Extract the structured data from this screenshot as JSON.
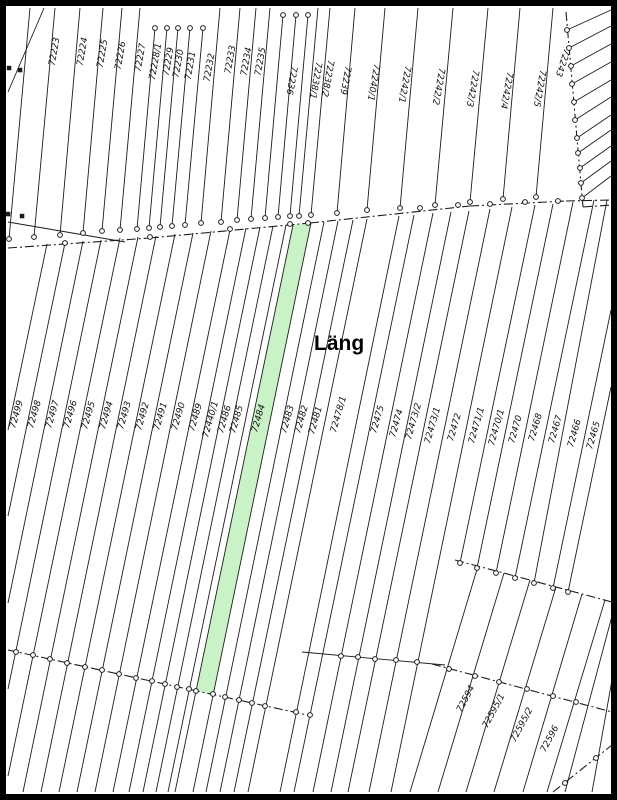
{
  "map": {
    "width": 617,
    "height": 800,
    "background": "#ffffff",
    "frame_color": "#000000",
    "line_color": "#1c1c1c",
    "label_color": "#111111",
    "highlighted_parcel": {
      "number": "72484",
      "fill": "#c9f2c6",
      "points": "293,225 311,223 213,694 196,691"
    },
    "area_label": {
      "text": "Läng",
      "x": 314,
      "y": 350,
      "size": 21
    },
    "parcel_numbers_top": [
      "72223",
      "72224",
      "72225",
      "72226",
      "72227",
      "72228/1",
      "72229",
      "72230",
      "72231",
      "72232",
      "72233",
      "72234",
      "72235",
      "72236",
      "72238/1",
      "72238/2",
      "72239",
      "72240/1",
      "72242/1",
      "72242/2",
      "72242/3",
      "72242/4",
      "72242/5",
      "72243"
    ],
    "parcel_numbers_middle": [
      "72499",
      "72498",
      "72497",
      "72496",
      "72495",
      "72494",
      "72493",
      "72492",
      "72491",
      "72490",
      "72489",
      "72440/1",
      "72486",
      "72485",
      "72484",
      "72483",
      "72482",
      "72481",
      "72478/1",
      "72475",
      "72474",
      "72473/2",
      "72473/1",
      "72472",
      "72471/1",
      "72470/1",
      "72470",
      "72468",
      "72467",
      "72466",
      "72465"
    ],
    "parcel_numbers_bottom_right": [
      "72594",
      "72595/1",
      "72595/2",
      "72596"
    ],
    "labels": [
      [
        "72223",
        57,
        52,
        -80
      ],
      [
        "72224",
        85,
        52,
        -80
      ],
      [
        "72225",
        105,
        54,
        -80
      ],
      [
        "72226",
        123,
        56,
        -80
      ],
      [
        "72227",
        143,
        58,
        -80
      ],
      [
        "72228/1",
        158,
        62,
        -80
      ],
      [
        "72229",
        171,
        62,
        -80
      ],
      [
        "72230",
        181,
        64,
        -80
      ],
      [
        "72231",
        193,
        66,
        -80
      ],
      [
        "72232",
        212,
        68,
        -80
      ],
      [
        "72233",
        233,
        60,
        -80
      ],
      [
        "72234",
        249,
        62,
        -80
      ],
      [
        "72235",
        263,
        62,
        -80
      ],
      [
        "72236",
        289,
        80,
        100
      ],
      [
        "72238/1",
        313,
        80,
        100
      ],
      [
        "72238/2",
        325,
        78,
        100
      ],
      [
        "72239",
        343,
        80,
        100
      ],
      [
        "72240/1",
        371,
        82,
        100
      ],
      [
        "72242/1",
        402,
        84,
        100
      ],
      [
        "72242/2",
        436,
        86,
        100
      ],
      [
        "72242/3",
        470,
        88,
        100
      ],
      [
        "72242/4",
        504,
        90,
        100
      ],
      [
        "72242/5",
        537,
        88,
        100
      ],
      [
        "72243",
        560,
        62,
        108
      ],
      [
        "72499",
        19,
        415,
        -74
      ],
      [
        "72498",
        37,
        415,
        -74
      ],
      [
        "72497",
        55,
        415,
        -74
      ],
      [
        "72496",
        73,
        415,
        -74
      ],
      [
        "72495",
        91,
        416,
        -74
      ],
      [
        "72494",
        109,
        416,
        -74
      ],
      [
        "72493",
        127,
        416,
        -74
      ],
      [
        "72492",
        145,
        417,
        -74
      ],
      [
        "72491",
        163,
        417,
        -74
      ],
      [
        "72490",
        181,
        417,
        -74
      ],
      [
        "72489",
        198,
        418,
        -74
      ],
      [
        "72440/1",
        213,
        420,
        -74
      ],
      [
        "72486",
        227,
        420,
        -74
      ],
      [
        "72485",
        239,
        420,
        -74
      ],
      [
        "72484",
        261,
        419,
        -74
      ],
      [
        "72483",
        290,
        420,
        -74
      ],
      [
        "72482",
        304,
        420,
        -74
      ],
      [
        "72481",
        318,
        421,
        -74
      ],
      [
        "72478/1",
        341,
        415,
        -74
      ],
      [
        "72475",
        380,
        420,
        -74
      ],
      [
        "72474",
        399,
        424,
        -74
      ],
      [
        "72473/2",
        416,
        422,
        -74
      ],
      [
        "72473/1",
        435,
        426,
        -74
      ],
      [
        "72472",
        457,
        428,
        -74
      ],
      [
        "72471/1",
        479,
        426,
        -74
      ],
      [
        "72470/1",
        499,
        428,
        -74
      ],
      [
        "72470",
        518,
        430,
        -74
      ],
      [
        "72468",
        538,
        428,
        -74
      ],
      [
        "72467",
        558,
        430,
        -74
      ],
      [
        "72466",
        577,
        434,
        -74
      ],
      [
        "72465",
        596,
        436,
        -74
      ],
      [
        "72594",
        468,
        700,
        -62
      ],
      [
        "72595/1",
        496,
        712,
        -62
      ],
      [
        "72595/2",
        524,
        726,
        -62
      ],
      [
        "72596",
        552,
        740,
        -62
      ]
    ],
    "solid_lines": [
      [
        30,
        8,
        9,
        239
      ],
      [
        55,
        8,
        34,
        237
      ],
      [
        80,
        8,
        60,
        235
      ],
      [
        103,
        8,
        83,
        233
      ],
      [
        122,
        8,
        102,
        231
      ],
      [
        140,
        8,
        120,
        230
      ],
      [
        155,
        28,
        137,
        229
      ],
      [
        167,
        28,
        149,
        228
      ],
      [
        178,
        28,
        160,
        227
      ],
      [
        190,
        28,
        172,
        226
      ],
      [
        203,
        28,
        185,
        225
      ],
      [
        220,
        8,
        201,
        223
      ],
      [
        240,
        8,
        221,
        222
      ],
      [
        256,
        8,
        237,
        220
      ],
      [
        270,
        8,
        251,
        219
      ],
      [
        283,
        15,
        265,
        218
      ],
      [
        296,
        15,
        278,
        217
      ],
      [
        308,
        15,
        290,
        216
      ],
      [
        318,
        8,
        299,
        216
      ],
      [
        330,
        8,
        311,
        215
      ],
      [
        355,
        8,
        337,
        213
      ],
      [
        385,
        8,
        367,
        210
      ],
      [
        418,
        8,
        400,
        208
      ],
      [
        453,
        8,
        435,
        205
      ],
      [
        488,
        8,
        470,
        202
      ],
      [
        520,
        8,
        503,
        199
      ],
      [
        553,
        8,
        536,
        197
      ],
      [
        567,
        30,
        611,
        10
      ],
      [
        569,
        48,
        611,
        26
      ],
      [
        571,
        66,
        611,
        44
      ],
      [
        572,
        84,
        611,
        62
      ],
      [
        574,
        102,
        611,
        80
      ],
      [
        575,
        120,
        611,
        97
      ],
      [
        577,
        138,
        611,
        115
      ],
      [
        578,
        153,
        611,
        130
      ],
      [
        580,
        168,
        611,
        146
      ],
      [
        581,
        183,
        611,
        161
      ],
      [
        582,
        198,
        611,
        176
      ],
      [
        47,
        244,
        8,
        430
      ],
      [
        65,
        243,
        8,
        516
      ],
      [
        83,
        241,
        8,
        603
      ],
      [
        101,
        240,
        8,
        689
      ],
      [
        120,
        238,
        8,
        776
      ],
      [
        138,
        237,
        23,
        792
      ],
      [
        156,
        236,
        41,
        792
      ],
      [
        175,
        234,
        59,
        792
      ],
      [
        193,
        233,
        77,
        792
      ],
      [
        211,
        231,
        95,
        792
      ],
      [
        230,
        230,
        113,
        792
      ],
      [
        246,
        228,
        129,
        792
      ],
      [
        260,
        227,
        143,
        792
      ],
      [
        273,
        226,
        156,
        792
      ],
      [
        286,
        225,
        168,
        792
      ],
      [
        293,
        225,
        175,
        792
      ],
      [
        311,
        223,
        193,
        792
      ],
      [
        324,
        222,
        206,
        792
      ],
      [
        338,
        221,
        220,
        792
      ],
      [
        353,
        220,
        234,
        792
      ],
      [
        367,
        219,
        248,
        792
      ],
      [
        399,
        216,
        280,
        792
      ],
      [
        414,
        215,
        294,
        792
      ],
      [
        433,
        213,
        313,
        792
      ],
      [
        451,
        212,
        331,
        792
      ],
      [
        469,
        211,
        348,
        792
      ],
      [
        490,
        209,
        369,
        792
      ],
      [
        512,
        207,
        391,
        792
      ],
      [
        535,
        205,
        460,
        563
      ],
      [
        553,
        204,
        477,
        568
      ],
      [
        573,
        202,
        496,
        573
      ],
      [
        594,
        200,
        515,
        578
      ],
      [
        607,
        200,
        534,
        583
      ],
      [
        611,
        310,
        553,
        588
      ],
      [
        611,
        387,
        568,
        592
      ],
      [
        478,
        566,
        410,
        792
      ],
      [
        504,
        573,
        438,
        792
      ],
      [
        530,
        580,
        466,
        792
      ],
      [
        556,
        587,
        494,
        792
      ],
      [
        582,
        594,
        523,
        792
      ],
      [
        605,
        600,
        547,
        792
      ],
      [
        612,
        616,
        565,
        792
      ],
      [
        612,
        680,
        592,
        792
      ],
      [
        8,
        222,
        125,
        242
      ],
      [
        8,
        92,
        44,
        8
      ],
      [
        302,
        652,
        445,
        665
      ]
    ],
    "dash_lines": [
      [
        8,
        248,
        150,
        238
      ],
      [
        150,
        238,
        310,
        223
      ],
      [
        310,
        223,
        470,
        206
      ],
      [
        470,
        206,
        566,
        201
      ],
      [
        566,
        201,
        611,
        200
      ],
      [
        566,
        12,
        583,
        207
      ],
      [
        583,
        207,
        611,
        205
      ],
      [
        8,
        650,
        312,
        716
      ],
      [
        455,
        560,
        612,
        602
      ],
      [
        432,
        664,
        612,
        712
      ],
      [
        553,
        792,
        612,
        745
      ]
    ],
    "circles": [
      [
        9,
        239
      ],
      [
        34,
        237
      ],
      [
        60,
        235
      ],
      [
        83,
        233
      ],
      [
        102,
        231
      ],
      [
        120,
        230
      ],
      [
        137,
        229
      ],
      [
        149,
        228
      ],
      [
        160,
        227
      ],
      [
        172,
        226
      ],
      [
        185,
        225
      ],
      [
        201,
        223
      ],
      [
        221,
        222
      ],
      [
        237,
        220
      ],
      [
        251,
        219
      ],
      [
        265,
        218
      ],
      [
        278,
        217
      ],
      [
        290,
        216
      ],
      [
        299,
        216
      ],
      [
        311,
        215
      ],
      [
        337,
        213
      ],
      [
        367,
        210
      ],
      [
        400,
        208
      ],
      [
        435,
        205
      ],
      [
        470,
        202
      ],
      [
        503,
        199
      ],
      [
        536,
        197
      ],
      [
        155,
        28
      ],
      [
        167,
        28
      ],
      [
        178,
        28
      ],
      [
        190,
        28
      ],
      [
        203,
        28
      ],
      [
        283,
        15
      ],
      [
        296,
        15
      ],
      [
        308,
        15
      ],
      [
        567,
        30
      ],
      [
        569,
        48
      ],
      [
        571,
        66
      ],
      [
        572,
        84
      ],
      [
        574,
        102
      ],
      [
        575,
        120
      ],
      [
        577,
        138
      ],
      [
        578,
        153
      ],
      [
        580,
        168
      ],
      [
        581,
        183
      ],
      [
        582,
        198
      ],
      [
        65,
        243
      ],
      [
        150,
        237
      ],
      [
        230,
        229
      ],
      [
        290,
        224
      ],
      [
        308,
        223
      ],
      [
        420,
        208
      ],
      [
        458,
        205
      ],
      [
        490,
        204
      ],
      [
        525,
        202
      ],
      [
        558,
        201
      ],
      [
        16,
        652
      ],
      [
        33,
        655
      ],
      [
        50,
        659
      ],
      [
        67,
        663
      ],
      [
        85,
        667
      ],
      [
        102,
        670
      ],
      [
        119,
        674
      ],
      [
        136,
        678
      ],
      [
        152,
        681
      ],
      [
        165,
        684
      ],
      [
        177,
        687
      ],
      [
        189,
        689
      ],
      [
        196,
        691
      ],
      [
        213,
        694
      ],
      [
        225,
        697
      ],
      [
        239,
        700
      ],
      [
        252,
        703
      ],
      [
        265,
        706
      ],
      [
        296,
        712
      ],
      [
        310,
        715
      ],
      [
        341,
        656
      ],
      [
        358,
        657
      ],
      [
        375,
        659
      ],
      [
        396,
        660
      ],
      [
        417,
        662
      ],
      [
        460,
        563
      ],
      [
        477,
        568
      ],
      [
        496,
        573
      ],
      [
        515,
        578
      ],
      [
        534,
        583
      ],
      [
        553,
        588
      ],
      [
        568,
        592
      ],
      [
        449,
        669
      ],
      [
        475,
        676
      ],
      [
        499,
        682
      ],
      [
        527,
        689
      ],
      [
        553,
        696
      ],
      [
        576,
        702
      ],
      [
        565,
        783
      ],
      [
        596,
        758
      ]
    ],
    "squares": [
      [
        9,
        68
      ],
      [
        20,
        70
      ],
      [
        8,
        214
      ],
      [
        22,
        216
      ]
    ]
  }
}
